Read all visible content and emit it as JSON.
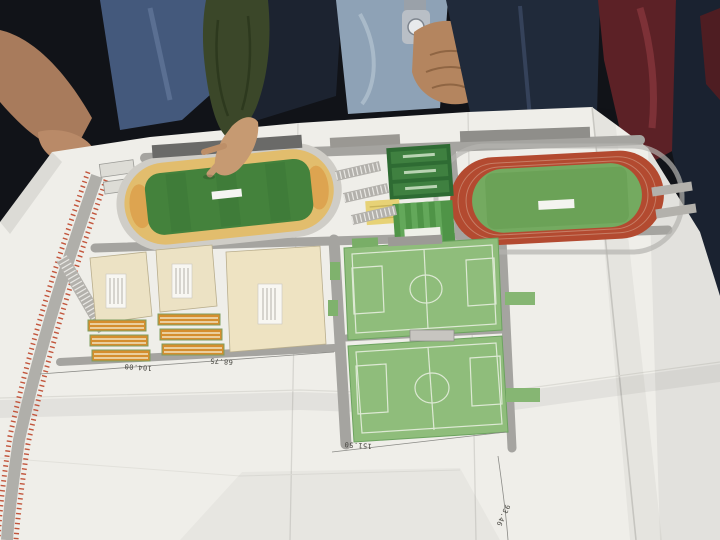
{
  "plan": {
    "dimension_labels": {
      "width_104": "104.00",
      "width_68": "68.75",
      "length_151": "151.50",
      "length_93": "93.46"
    },
    "colors": {
      "paper": "#efeee9",
      "pitch_green": "#44823c",
      "light_pitch_green": "#8fbd7b",
      "infield_green": "#6ba257",
      "track_red": "#b34a30",
      "stand_tan": "#e2bd6d",
      "plot_beige": "#ece2c4",
      "court_orange": "#d58e2e",
      "road_gray": "#a5a4a0",
      "hatch_red": "#c2553c",
      "couch_maroon": "#5c2126",
      "sleeve_green": "#3b4729",
      "skin": "#c69a72"
    }
  }
}
